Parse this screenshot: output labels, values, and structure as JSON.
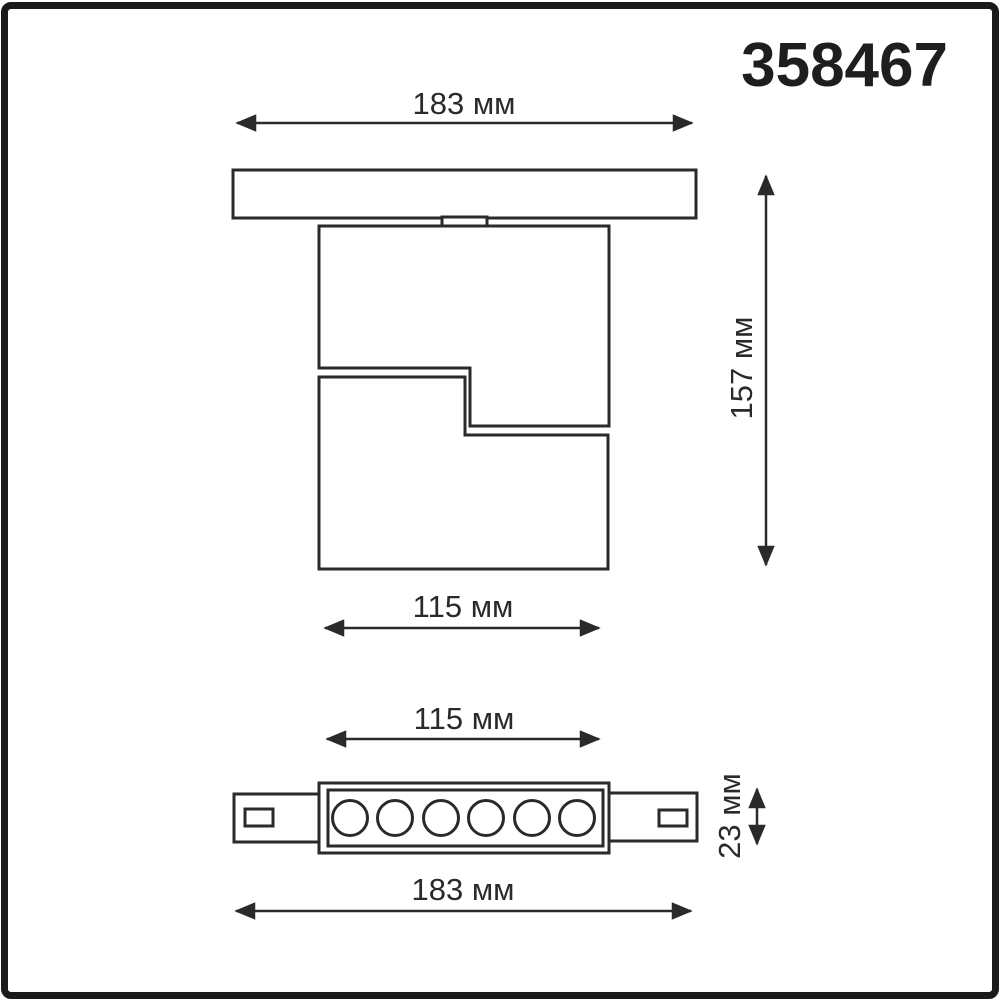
{
  "product_code": "358467",
  "unit": "мм",
  "colors": {
    "ink": "#2a2a2a",
    "frame": "#1a1a1a",
    "background": "#ffffff"
  },
  "views": {
    "side": {
      "overall_width": {
        "value": 183,
        "label": "183 мм"
      },
      "overall_height": {
        "value": 157,
        "label": "157 мм"
      },
      "head_width": {
        "value": 115,
        "label": "115 мм"
      }
    },
    "bottom": {
      "head_width": {
        "value": 115,
        "label": "115 мм"
      },
      "body_depth": {
        "value": 23,
        "label": "23 мм"
      },
      "overall_width": {
        "value": 183,
        "label": "183 мм"
      },
      "led_count": 6
    }
  }
}
